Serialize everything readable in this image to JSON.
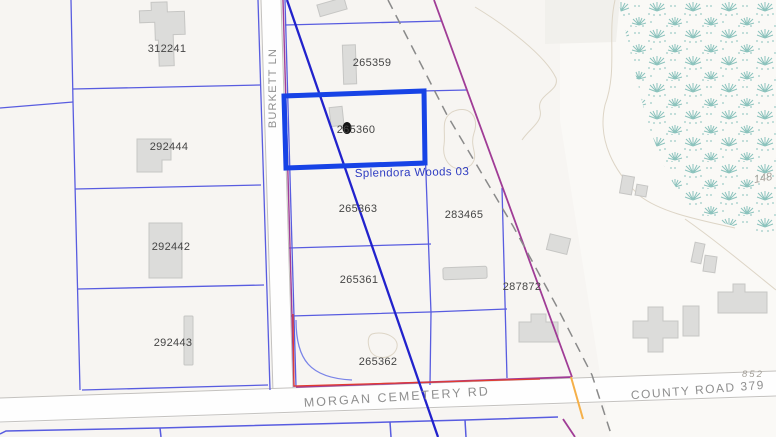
{
  "map": {
    "type": "gis-parcel-map",
    "selected_parcel": {
      "id": "265360",
      "subdivision": "Splendora Woods 03"
    },
    "parcel_labels": [
      {
        "id": "312241"
      },
      {
        "id": "292444"
      },
      {
        "id": "292442"
      },
      {
        "id": "292443"
      },
      {
        "id": "265359"
      },
      {
        "id": "265360"
      },
      {
        "id": "265363"
      },
      {
        "id": "283465"
      },
      {
        "id": "265361"
      },
      {
        "id": "287872"
      },
      {
        "id": "265362"
      }
    ],
    "road_labels": [
      {
        "name": "BURKETT LN"
      },
      {
        "name": "MORGAN CEMETERY RD"
      },
      {
        "name": "COUNTY ROAD 379"
      }
    ],
    "annotation_labels": [
      {
        "text": "Splendora Woods 03"
      }
    ],
    "elevation_labels": [
      {
        "text": "148"
      },
      {
        "text": "852"
      }
    ],
    "colors": {
      "background": "#f7f5f2",
      "parcel_line": "#585ce0",
      "selection_highlight": "#1743e6",
      "overlay_line": "#2222cc",
      "subdivision_boundary": "#a03c96",
      "survey_dashed_line": "#8a8a8a",
      "red_boundary": "#e23b30",
      "orange_segment": "#f5b04a",
      "vegetation": "#8cc3bd",
      "building_fill": "#dcdcda",
      "road_edge": "#c4c2bf",
      "road_label": "#8f8f8f"
    }
  }
}
